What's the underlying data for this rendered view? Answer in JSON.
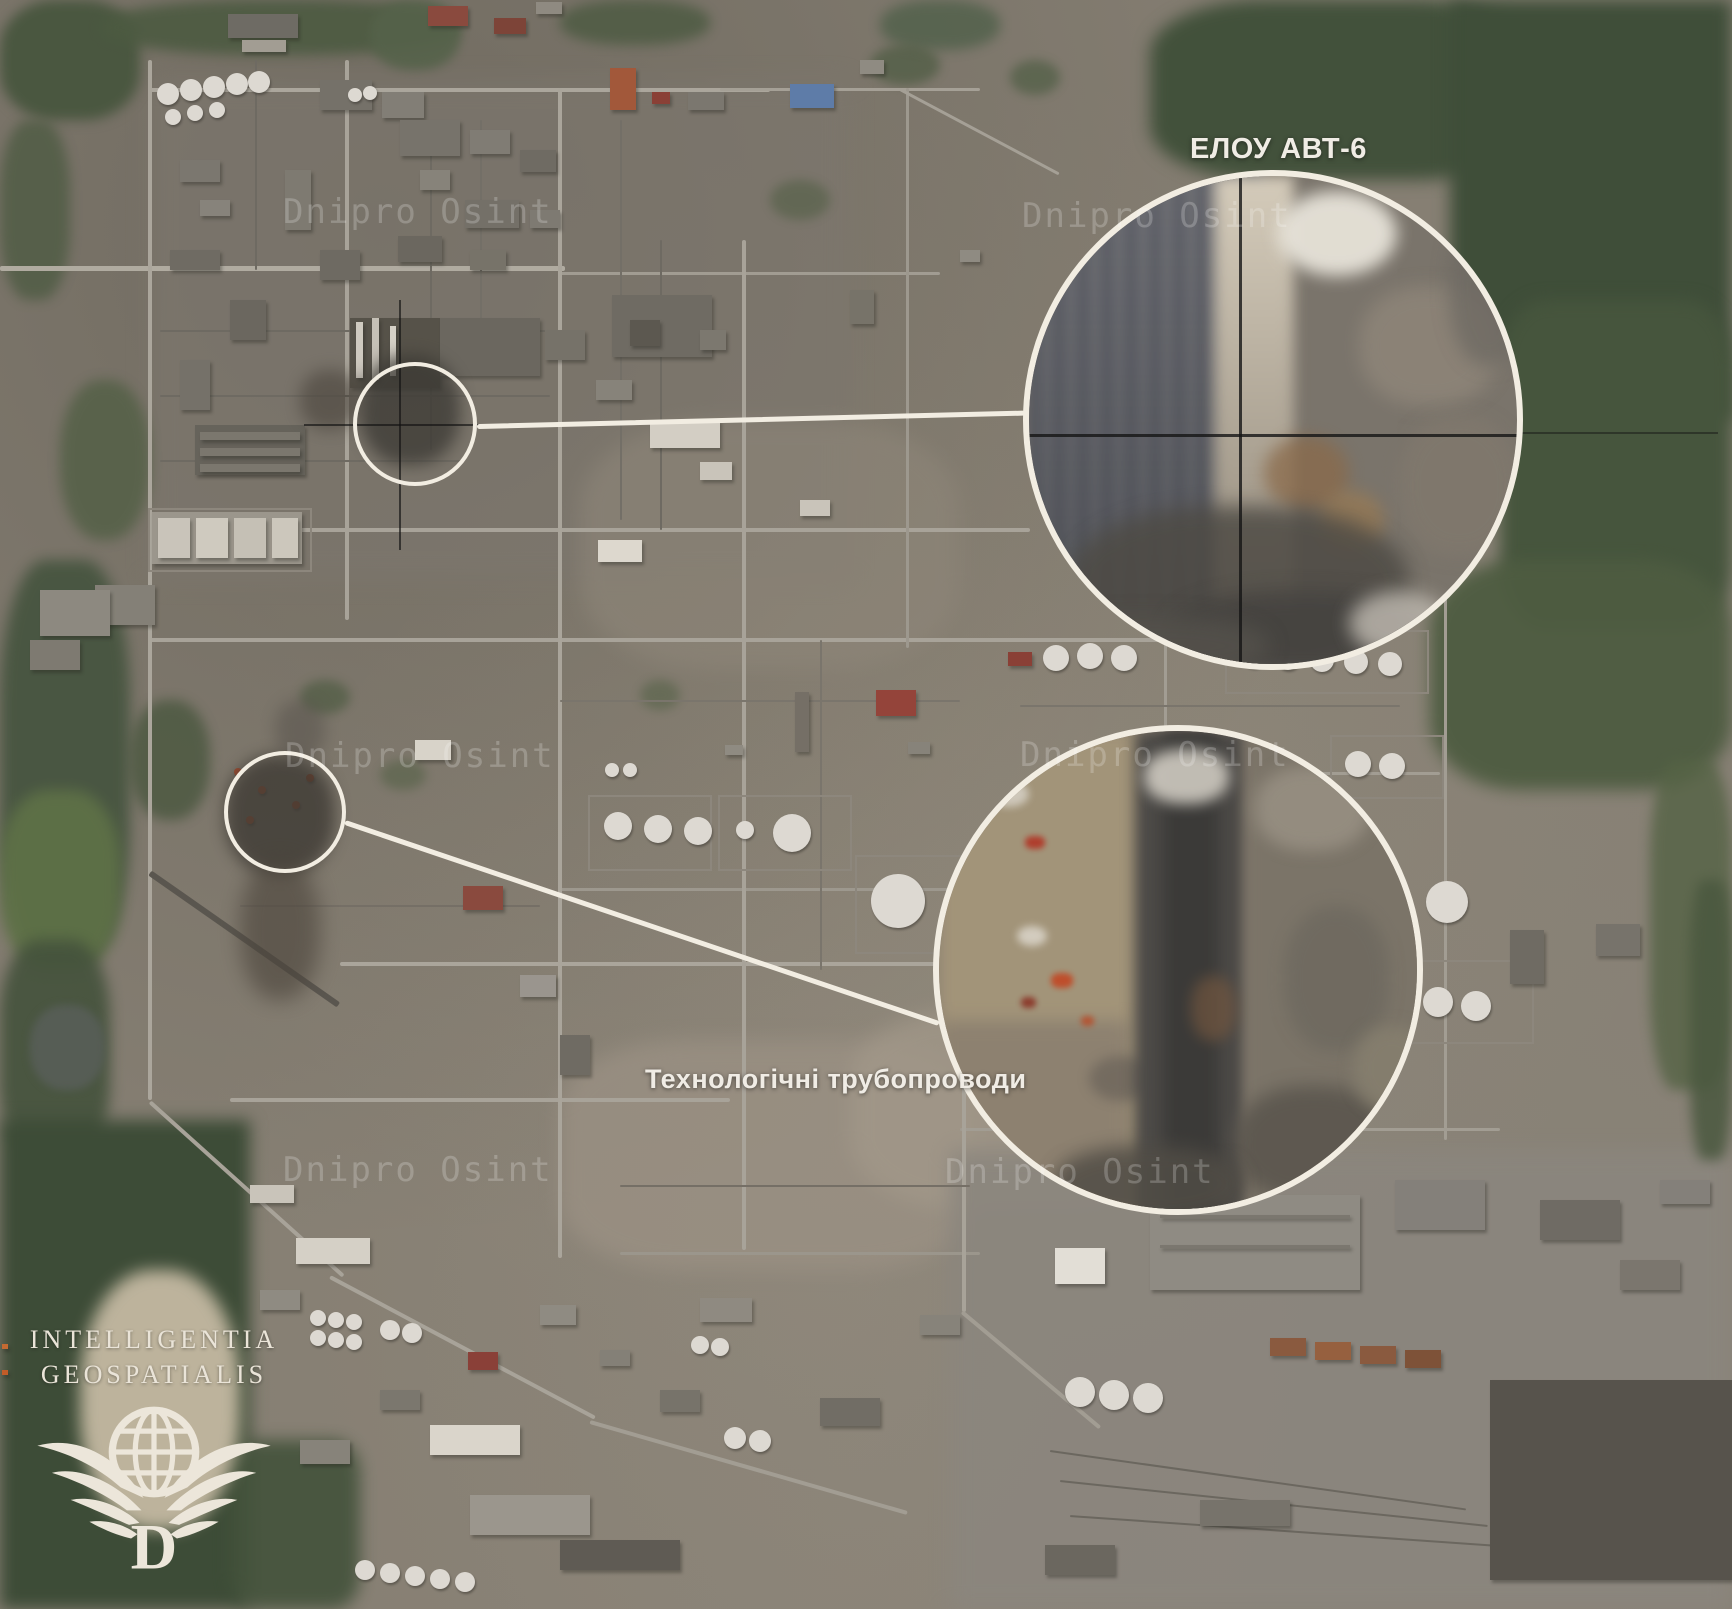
{
  "annotations": {
    "top_callout": {
      "label": "ЕЛОУ АВТ-6"
    },
    "bottom_callout": {
      "label": "Технологічні трубопроводи"
    }
  },
  "watermark": {
    "text": "Dnipro Osint"
  },
  "logo": {
    "line1": "INTELLIGENTIA",
    "line2": "GEOSPATIALIS",
    "monogram": "D"
  },
  "colors": {
    "annotation_white": "#f2ede2",
    "label_text": "#f0ece5",
    "watermark_text": "#ffffff",
    "crosshair_black": "#151515",
    "logo_cream": "#eae4d8",
    "terrain_base": "#867f73",
    "vegetation_dark": "#42513b"
  }
}
